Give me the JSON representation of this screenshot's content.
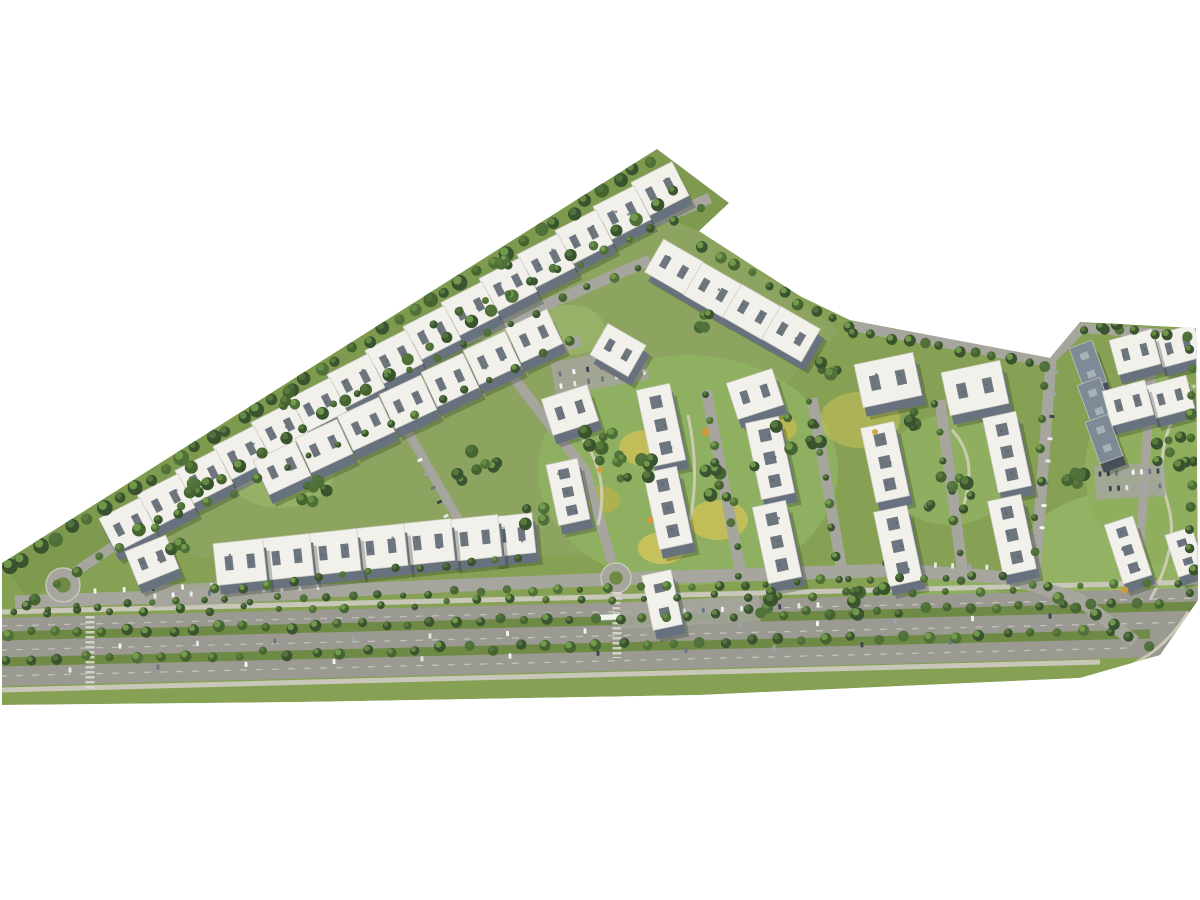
{
  "image": {
    "kind": "aerial-masterplan-3d-render",
    "width": 1200,
    "height": 900
  },
  "palette": {
    "background": "#ffffff",
    "ground": "#86a154",
    "upper_overlay": "#a3ad80",
    "grass_strip": "#7d9a4e",
    "road": "#a6a69e",
    "road_dark": "#9a9a92",
    "sidewalk": "#c9c7ba",
    "path": "#d3d1bd",
    "median_green": "#6f8a45",
    "lane_dash": "#d6d5cc",
    "roof": "#f1f0ea",
    "roof_edge": "#c9c8c0",
    "roof_detail": "#5a646e",
    "facade": "#68727e",
    "roof_dark": "#7e8a96",
    "facade_dark": "#46505b",
    "roof_detail_dark": "#aeb6bd",
    "shadow": "rgba(35,45,25,0.28)",
    "crosswalk": "#dddcd2",
    "bus": "#f2f2ef",
    "tree_dark": [
      "#3a5430",
      "#45642f",
      "#4f7038",
      "#39532e"
    ],
    "tree_light": [
      "#5b7d3e",
      "#6b8f48",
      "#547440",
      "#76a04f"
    ],
    "car_colors": [
      "#f5f5f5",
      "#394450",
      "#9aa4ad",
      "#6b7684",
      "#e8e8e8"
    ],
    "accent_orange": "#d59a39"
  },
  "scene": {
    "site_outline": [
      [
        657,
        149
      ],
      [
        729,
        203
      ],
      [
        699,
        231
      ],
      [
        800,
        296
      ],
      [
        850,
        320
      ],
      [
        1050,
        358
      ],
      [
        1080,
        322
      ],
      [
        1196,
        328
      ],
      [
        1198,
        600
      ],
      [
        1160,
        655
      ],
      [
        1080,
        678
      ],
      [
        700,
        695
      ],
      [
        300,
        702
      ],
      [
        2,
        705
      ],
      [
        2,
        563
      ]
    ],
    "green_strip": [
      [
        2,
        563
      ],
      [
        657,
        149
      ],
      [
        729,
        203
      ],
      [
        699,
        231
      ],
      [
        645,
        210
      ],
      [
        28,
        600
      ]
    ],
    "upper_overlay": [
      [
        140,
        535
      ],
      [
        660,
        200
      ],
      [
        700,
        228
      ],
      [
        800,
        300
      ],
      [
        840,
        332
      ],
      [
        600,
        555
      ],
      [
        200,
        558
      ]
    ],
    "lawns": [
      [
        688,
        470,
        150,
        115,
        "#8fb061",
        1
      ],
      [
        645,
        448,
        26,
        18,
        "#c6bf58",
        0.9
      ],
      [
        718,
        520,
        30,
        20,
        "#c6bf58",
        0.9
      ],
      [
        775,
        428,
        22,
        15,
        "#bdb94f",
        0.9
      ],
      [
        662,
        548,
        24,
        16,
        "#cdc45e",
        0.9
      ],
      [
        600,
        500,
        20,
        14,
        "#b5b14c",
        0.85
      ],
      [
        1130,
        560,
        110,
        70,
        "#93b264",
        1
      ],
      [
        1160,
        470,
        75,
        95,
        "#8fae5e",
        1
      ],
      [
        1120,
        607,
        42,
        18,
        "#c2bc55",
        0.9
      ],
      [
        950,
        470,
        65,
        55,
        "#90ae60",
        1
      ],
      [
        860,
        420,
        40,
        28,
        "#c6bf58",
        0.6
      ],
      [
        480,
        300,
        60,
        40,
        "#96b266",
        0.9
      ],
      [
        380,
        385,
        55,
        38,
        "#96b266",
        0.9
      ],
      [
        280,
        470,
        55,
        38,
        "#96b266",
        0.9
      ],
      [
        620,
        210,
        48,
        28,
        "#93b060",
        0.9
      ],
      [
        570,
        330,
        35,
        25,
        "#9ab56a",
        0.8
      ],
      [
        940,
        600,
        60,
        30,
        "#8fb061",
        0.9
      ]
    ],
    "streets": [
      {
        "pts": [
          [
            432,
            318
          ],
          [
            710,
            198
          ]
        ],
        "w": 11
      },
      {
        "pts": [
          [
            330,
            398
          ],
          [
            650,
            260
          ]
        ],
        "w": 11
      },
      {
        "pts": [
          [
            150,
            522
          ],
          [
            580,
            340
          ]
        ],
        "w": 11
      },
      {
        "pts": [
          [
            408,
            432
          ],
          [
            470,
            540
          ]
        ],
        "w": 9
      },
      {
        "pts": [
          [
            492,
            350
          ],
          [
            585,
            470
          ],
          [
            612,
            562
          ]
        ],
        "w": 10
      },
      {
        "pts": [
          [
            706,
            390
          ],
          [
            742,
            580
          ]
        ],
        "w": 11
      },
      {
        "pts": [
          [
            812,
            398
          ],
          [
            844,
            582
          ]
        ],
        "w": 11
      },
      {
        "pts": [
          [
            940,
            400
          ],
          [
            964,
            582
          ]
        ],
        "w": 11
      },
      {
        "pts": [
          [
            1052,
            348
          ],
          [
            1034,
            588
          ]
        ],
        "w": 11
      },
      {
        "pts": [
          [
            852,
            326
          ],
          [
            1048,
            362
          ],
          [
            1082,
            328
          ],
          [
            1190,
            336
          ]
        ],
        "w": 10
      },
      {
        "pts": [
          [
            1152,
            360
          ],
          [
            1140,
            548
          ]
        ],
        "w": 9
      },
      {
        "pts": [
          [
            75,
            572
          ],
          [
            150,
            522
          ]
        ],
        "w": 10
      },
      {
        "pts": [
          [
            616,
            578
          ],
          [
            616,
            600
          ]
        ],
        "w": 14
      }
    ],
    "collector": {
      "pts": [
        [
          15,
          602
        ],
        [
          300,
          592
        ],
        [
          612,
          579
        ],
        [
          900,
          570
        ],
        [
          1010,
          578
        ],
        [
          1080,
          600
        ],
        [
          1135,
          642
        ]
      ],
      "w": 13
    },
    "arterial": {
      "center": [
        [
          0,
          652
        ],
        [
          1198,
          622
        ]
      ],
      "width": 68,
      "sidewalk_n": [
        [
          0,
          612
        ],
        [
          1198,
          582
        ]
      ],
      "sidewalk_s": [
        [
          0,
          690
        ],
        [
          1100,
          662
        ]
      ],
      "medians": [
        [
          [
            2,
            636
          ],
          [
            1198,
            606
          ]
        ],
        [
          [
            2,
            662
          ],
          [
            1150,
            634
          ]
        ]
      ],
      "dashes": [
        [
          [
            0,
            626
          ],
          [
            1198,
            598
          ]
        ],
        [
          [
            0,
            650
          ],
          [
            1198,
            622
          ]
        ],
        [
          [
            0,
            676
          ],
          [
            1130,
            648
          ]
        ]
      ]
    },
    "paths": [
      "M575,430 Q612,470 598,525",
      "M688,415 Q700,470 690,520",
      "M862,428 Q898,470 880,540",
      "M1195,385 Q1148,440 1168,505 Q1180,545 1150,600",
      "M1100,676 Q1158,662 1188,612",
      "M952,430 Q980,460 962,510"
    ],
    "roundabouts": [
      [
        63,
        585,
        17
      ],
      [
        616,
        578,
        15
      ]
    ],
    "crosswalks": [
      [
        90,
        616,
        90,
        690
      ],
      [
        617,
        592,
        617,
        658
      ]
    ],
    "pads": [
      [
        600,
        371,
        95,
        34,
        -10
      ],
      [
        1130,
        481,
        70,
        34,
        -3
      ],
      [
        690,
        612,
        140,
        26,
        -3
      ],
      [
        237,
        592,
        170,
        22,
        -3
      ]
    ],
    "bus": [
      610,
      617,
      -3,
      22,
      6
    ],
    "car_rows": [
      [
        155,
        596,
        318,
        587,
        10
      ],
      [
        560,
        374,
        643,
        360,
        7
      ],
      [
        561,
        386,
        644,
        372,
        7
      ],
      [
        665,
        612,
        818,
        605,
        9
      ],
      [
        884,
        563,
        1004,
        568,
        8
      ],
      [
        1100,
        474,
        1158,
        471,
        8
      ],
      [
        1102,
        489,
        1160,
        486,
        8
      ],
      [
        1056,
        372,
        1040,
        550,
        9
      ],
      [
        120,
        646,
        1050,
        616,
        13
      ],
      [
        70,
        670,
        950,
        642,
        11
      ],
      [
        420,
        460,
        446,
        516,
        5
      ],
      [
        95,
        591,
        270,
        583,
        7
      ]
    ],
    "buildings": [
      [
        128,
        525,
        -27,
        46,
        38,
        0
      ],
      [
        166,
        501,
        -27,
        46,
        38,
        0
      ],
      [
        204,
        477,
        -27,
        46,
        38,
        0
      ],
      [
        242,
        453,
        -27,
        46,
        38,
        0
      ],
      [
        280,
        429,
        -27,
        46,
        38,
        0
      ],
      [
        318,
        405,
        -27,
        46,
        38,
        0
      ],
      [
        356,
        381,
        -27,
        46,
        38,
        0
      ],
      [
        394,
        357,
        -27,
        46,
        38,
        0
      ],
      [
        432,
        333,
        -27,
        46,
        38,
        0
      ],
      [
        470,
        309,
        -27,
        46,
        38,
        0
      ],
      [
        508,
        285,
        -27,
        46,
        38,
        0
      ],
      [
        546,
        261,
        -27,
        46,
        38,
        0
      ],
      [
        584,
        237,
        -27,
        46,
        38,
        0
      ],
      [
        622,
        213,
        -27,
        46,
        38,
        0
      ],
      [
        660,
        189,
        -27,
        46,
        38,
        0
      ],
      [
        282,
        468,
        -25,
        46,
        38,
        0
      ],
      [
        324,
        446,
        -25,
        46,
        38,
        0
      ],
      [
        366,
        424,
        -25,
        46,
        38,
        0
      ],
      [
        408,
        402,
        -25,
        46,
        38,
        0
      ],
      [
        450,
        380,
        -25,
        46,
        38,
        0
      ],
      [
        492,
        358,
        -25,
        46,
        38,
        0
      ],
      [
        534,
        336,
        -25,
        46,
        38,
        0
      ],
      [
        674,
        267,
        30,
        46,
        38,
        0
      ],
      [
        713,
        290,
        30,
        46,
        38,
        0
      ],
      [
        752,
        312,
        30,
        46,
        38,
        0
      ],
      [
        791,
        334,
        30,
        46,
        38,
        0
      ],
      [
        618,
        350,
        30,
        44,
        36,
        0
      ],
      [
        240,
        562,
        -6,
        50,
        42,
        0
      ],
      [
        287,
        557,
        -6,
        50,
        42,
        0
      ],
      [
        334,
        552,
        -6,
        50,
        42,
        0
      ],
      [
        381,
        547,
        -6,
        50,
        42,
        0
      ],
      [
        428,
        542,
        -6,
        50,
        42,
        0
      ],
      [
        475,
        538,
        -6,
        50,
        42,
        0
      ],
      [
        512,
        535,
        -6,
        44,
        40,
        0
      ],
      [
        152,
        560,
        -22,
        44,
        36,
        0
      ],
      [
        570,
        410,
        -18,
        48,
        38,
        0
      ],
      [
        755,
        394,
        -18,
        48,
        38,
        0
      ],
      [
        661,
        425,
        78,
        78,
        34,
        1
      ],
      [
        668,
        508,
        78,
        78,
        34,
        1
      ],
      [
        662,
        600,
        78,
        56,
        30,
        1
      ],
      [
        568,
        492,
        78,
        62,
        32,
        1
      ],
      [
        770,
        458,
        78,
        78,
        34,
        1
      ],
      [
        777,
        542,
        78,
        78,
        34,
        1
      ],
      [
        888,
        380,
        -12,
        60,
        44,
        0
      ],
      [
        975,
        388,
        -12,
        60,
        44,
        0
      ],
      [
        885,
        462,
        78,
        76,
        34,
        1
      ],
      [
        898,
        546,
        78,
        76,
        34,
        1
      ],
      [
        1007,
        452,
        78,
        76,
        34,
        1
      ],
      [
        1012,
        535,
        78,
        76,
        34,
        1
      ],
      [
        1088,
        365,
        70,
        44,
        24,
        2
      ],
      [
        1096,
        402,
        70,
        44,
        24,
        2
      ],
      [
        1104,
        439,
        70,
        44,
        24,
        2
      ],
      [
        1135,
        352,
        -15,
        44,
        36,
        0
      ],
      [
        1178,
        346,
        -15,
        42,
        34,
        0
      ],
      [
        1128,
        403,
        -15,
        44,
        36,
        0
      ],
      [
        1170,
        397,
        -15,
        42,
        34,
        0
      ],
      [
        1128,
        550,
        72,
        62,
        30,
        1
      ],
      [
        1185,
        552,
        72,
        44,
        28,
        1
      ]
    ],
    "tree_lines": [
      [
        8,
        568,
        650,
        162,
        42,
        5,
        8
      ],
      [
        36,
        598,
        676,
        192,
        32,
        4,
        7
      ],
      [
        704,
        247,
        846,
        330,
        10,
        4,
        6
      ],
      [
        856,
        332,
        1044,
        364,
        12,
        4,
        6
      ],
      [
        1086,
        328,
        1186,
        336,
        7,
        4,
        6
      ],
      [
        1192,
        348,
        1192,
        595,
        12,
        4,
        6
      ],
      [
        8,
        634,
        1160,
        604,
        50,
        4,
        6
      ],
      [
        8,
        660,
        1108,
        632,
        44,
        4,
        6
      ],
      [
        12,
        614,
        1180,
        585,
        36,
        3,
        5
      ],
      [
        24,
        608,
        608,
        586,
        24,
        3,
        5
      ],
      [
        640,
        586,
        1000,
        576,
        15,
        3,
        5
      ],
      [
        436,
        324,
        700,
        210,
        12,
        3,
        5
      ],
      [
        334,
        402,
        640,
        266,
        13,
        3,
        5
      ],
      [
        155,
        526,
        570,
        344,
        17,
        3,
        5
      ],
      [
        704,
        392,
        740,
        576,
        8,
        3,
        5
      ],
      [
        810,
        400,
        842,
        580,
        8,
        3,
        5
      ],
      [
        937,
        402,
        962,
        580,
        7,
        3,
        5
      ],
      [
        1048,
        352,
        1032,
        584,
        8,
        3,
        5
      ],
      [
        1058,
        596,
        1148,
        646,
        6,
        4,
        6
      ],
      [
        215,
        590,
        520,
        556,
        13,
        3,
        5
      ]
    ],
    "tree_clusters": [
      [
        612,
        455,
        60,
        11
      ],
      [
        730,
        482,
        50,
        8
      ],
      [
        798,
        432,
        45,
        7
      ],
      [
        948,
        492,
        50,
        8
      ],
      [
        868,
        600,
        38,
        6
      ],
      [
        1168,
        452,
        38,
        7
      ],
      [
        478,
        468,
        42,
        7
      ],
      [
        380,
        310,
        36,
        5
      ],
      [
        310,
        488,
        45,
        8
      ],
      [
        192,
        480,
        36,
        5
      ],
      [
        540,
        520,
        30,
        5
      ],
      [
        700,
        320,
        26,
        4
      ],
      [
        828,
        368,
        26,
        4
      ],
      [
        1075,
        480,
        30,
        5
      ],
      [
        920,
        420,
        25,
        4
      ],
      [
        500,
        258,
        24,
        4
      ],
      [
        640,
        470,
        30,
        5
      ],
      [
        1110,
        320,
        22,
        4
      ],
      [
        760,
        600,
        30,
        5
      ],
      [
        180,
        545,
        26,
        4
      ],
      [
        290,
        396,
        30,
        5
      ]
    ],
    "accents": [
      [
        706,
        432,
        4
      ],
      [
        650,
        520,
        3.5
      ],
      [
        1125,
        590,
        3.5
      ],
      [
        875,
        432,
        3
      ],
      [
        600,
        470,
        3
      ]
    ]
  }
}
